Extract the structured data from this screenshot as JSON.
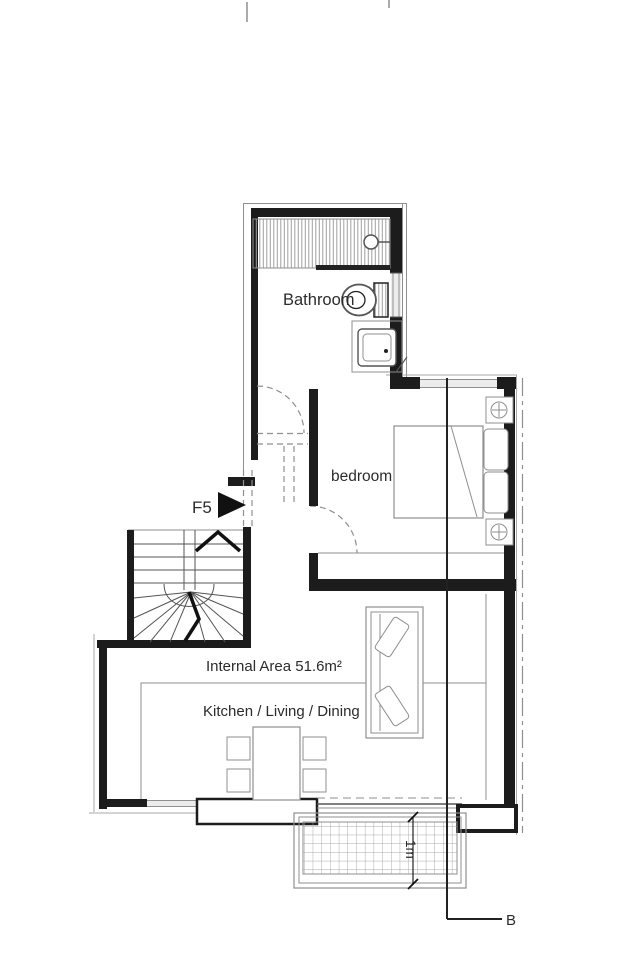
{
  "plan": {
    "rooms": {
      "bathroom": "Bathroom",
      "bedroom": "bedroom",
      "kitchen_living_dining": "Kitchen / Living / Dining"
    },
    "annotations": {
      "internal_area": "Internal Area 51.6m²",
      "unit_ref": "F5",
      "balcony_depth": "1m",
      "section_marker": "B"
    },
    "colors": {
      "background": "#ffffff",
      "wall": "#1c1c1c",
      "line-strong": "#222222",
      "line-medium": "#555555",
      "line-thin": "#8f8f8f",
      "line-faint": "#aaaaaa",
      "hatch": "#a0a0a0",
      "window-fill": "#ececec",
      "text": "#2b2b2b"
    }
  }
}
